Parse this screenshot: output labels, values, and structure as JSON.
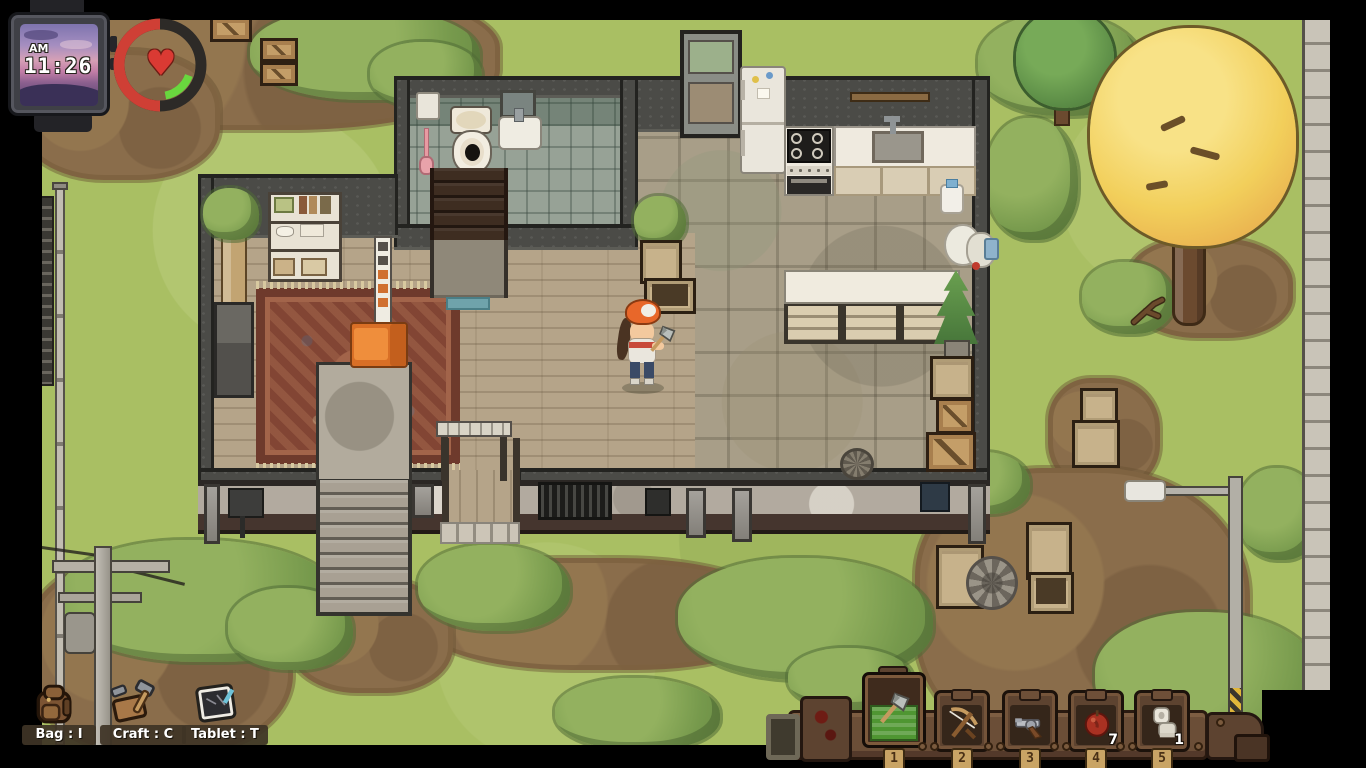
{
  "hud": {
    "watch": {
      "meridiem": "AM",
      "time": "11:26"
    },
    "vitals": {
      "heart_glyph": "♥",
      "health_color": "#d24036",
      "ring_track_color": "#2d2a27",
      "stamina_color": "#6fd83f"
    },
    "shortcuts": [
      {
        "id": "bag",
        "label": "Bag : I",
        "icon": "backpack-icon"
      },
      {
        "id": "craft",
        "label": "Craft : C",
        "icon": "craft-icon"
      },
      {
        "id": "tablet",
        "label": "Tablet : T",
        "icon": "tablet-icon"
      }
    ],
    "hotbar": {
      "selected_slot": "1",
      "selected_highlight_color": "#4f9632",
      "slots": [
        {
          "number": "1",
          "item": "hatchet",
          "count": "",
          "selected": true
        },
        {
          "number": "2",
          "item": "crossbow",
          "count": "",
          "selected": false
        },
        {
          "number": "3",
          "item": "revolver",
          "count": "",
          "selected": false
        },
        {
          "number": "4",
          "item": "apple",
          "count": "7",
          "selected": false
        },
        {
          "number": "5",
          "item": "toilet-paper",
          "count": "1",
          "selected": false
        }
      ]
    }
  },
  "scene": {
    "palette": {
      "grass": "#a9bf63",
      "dirt": "#8a6d4b",
      "wood_floor": "#b5a489",
      "stone_floor": "#a89e88",
      "bathroom_tile": "#97a296",
      "wall": "#4b4b47",
      "autumn_tree": "#f2cf5b",
      "sofa_orange": "#e07a2c"
    }
  }
}
